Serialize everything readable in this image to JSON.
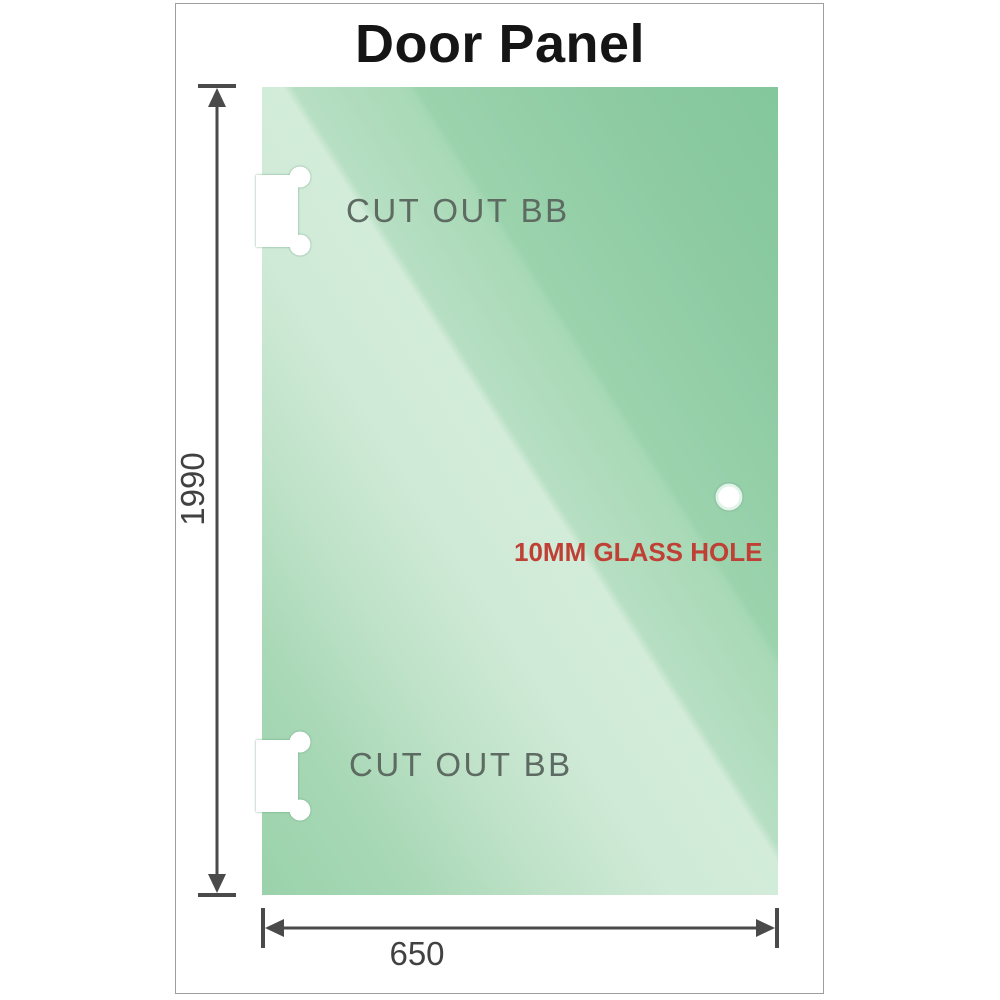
{
  "title": "Door Panel",
  "panel": {
    "cutout_top_label": "CUT OUT BB",
    "cutout_bottom_label": "CUT OUT BB",
    "hole_label": "10MM GLASS HOLE"
  },
  "dimensions": {
    "height": "1990",
    "width": "650"
  },
  "colors": {
    "glass_dark": "#84c79c",
    "glass_light": "#d3ecda",
    "dimension_gray": "#4a4a4a",
    "hole_label_red": "#bf4136",
    "cutout_label_gray": "#5d6b62",
    "frame_border_gray": "#9e9e9e",
    "title_black": "#151515"
  }
}
